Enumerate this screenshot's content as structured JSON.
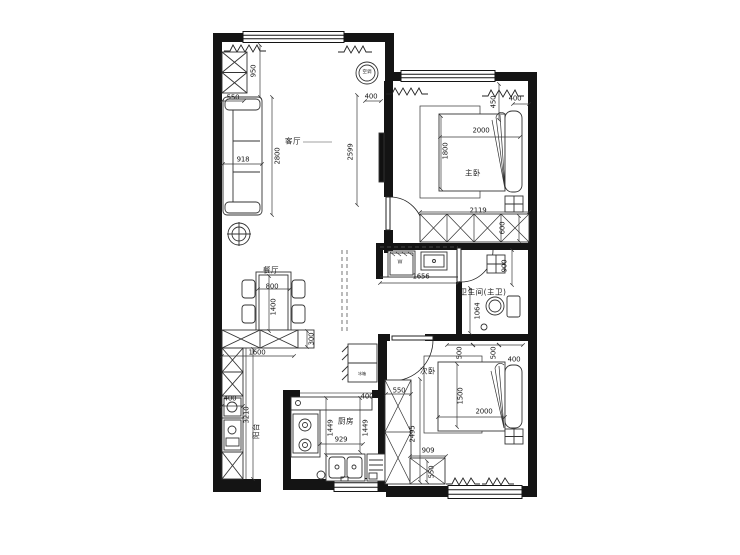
{
  "plan": {
    "room_labels": [
      {
        "text": "客厅",
        "x": 293,
        "y": 141,
        "rot": 0
      },
      {
        "text": "主卧",
        "x": 473,
        "y": 173,
        "rot": 0
      },
      {
        "text": "餐厅",
        "x": 271,
        "y": 270,
        "rot": 0
      },
      {
        "text": "卫生间(主卫)",
        "x": 483,
        "y": 292,
        "rot": 0
      },
      {
        "text": "次卧",
        "x": 428,
        "y": 371,
        "rot": 0
      },
      {
        "text": "厨房",
        "x": 346,
        "y": 421,
        "rot": 0
      },
      {
        "text": "阳台",
        "x": 256,
        "y": 431,
        "rot": 90
      }
    ],
    "dim_labels": [
      {
        "text": "950",
        "x": 254,
        "y": 71,
        "rot": 90
      },
      {
        "text": "550",
        "x": 233,
        "y": 98,
        "rot": 0
      },
      {
        "text": "918",
        "x": 243,
        "y": 160,
        "rot": 0
      },
      {
        "text": "2800",
        "x": 278,
        "y": 156,
        "rot": 90
      },
      {
        "text": "2599",
        "x": 351,
        "y": 152,
        "rot": 90
      },
      {
        "text": "400",
        "x": 371,
        "y": 97,
        "rot": 0
      },
      {
        "text": "450",
        "x": 494,
        "y": 102,
        "rot": 90
      },
      {
        "text": "400",
        "x": 515,
        "y": 99,
        "rot": 0
      },
      {
        "text": "2000",
        "x": 481,
        "y": 131,
        "rot": 0
      },
      {
        "text": "1800",
        "x": 446,
        "y": 151,
        "rot": 90
      },
      {
        "text": "2119",
        "x": 478,
        "y": 211,
        "rot": 0
      },
      {
        "text": "600",
        "x": 503,
        "y": 228,
        "rot": 90
      },
      {
        "text": "1656",
        "x": 421,
        "y": 277,
        "rot": 0
      },
      {
        "text": "900",
        "x": 505,
        "y": 266,
        "rot": 90
      },
      {
        "text": "1064",
        "x": 478,
        "y": 311,
        "rot": 90
      },
      {
        "text": "800",
        "x": 272,
        "y": 287,
        "rot": 0
      },
      {
        "text": "1400",
        "x": 274,
        "y": 307,
        "rot": 90
      },
      {
        "text": "300",
        "x": 312,
        "y": 339,
        "rot": 90
      },
      {
        "text": "1600",
        "x": 257,
        "y": 353,
        "rot": 0
      },
      {
        "text": "400",
        "x": 230,
        "y": 399,
        "rot": 0
      },
      {
        "text": "3210",
        "x": 247,
        "y": 415,
        "rot": 90
      },
      {
        "text": "1449",
        "x": 331,
        "y": 428,
        "rot": 90
      },
      {
        "text": "929",
        "x": 341,
        "y": 440,
        "rot": 0
      },
      {
        "text": "1449",
        "x": 366,
        "y": 428,
        "rot": 90
      },
      {
        "text": "400",
        "x": 367,
        "y": 397,
        "rot": 0
      },
      {
        "text": "550",
        "x": 399,
        "y": 391,
        "rot": 0
      },
      {
        "text": "500",
        "x": 460,
        "y": 353,
        "rot": 90
      },
      {
        "text": "500",
        "x": 494,
        "y": 353,
        "rot": 90
      },
      {
        "text": "400",
        "x": 514,
        "y": 360,
        "rot": 0
      },
      {
        "text": "1500",
        "x": 461,
        "y": 396,
        "rot": 90
      },
      {
        "text": "2000",
        "x": 484,
        "y": 412,
        "rot": 0
      },
      {
        "text": "2495",
        "x": 413,
        "y": 434,
        "rot": 90
      },
      {
        "text": "909",
        "x": 428,
        "y": 451,
        "rot": 0
      },
      {
        "text": "550",
        "x": 432,
        "y": 472,
        "rot": 90
      }
    ],
    "fixture_labels": [
      {
        "text": "空调",
        "x": 367,
        "y": 73,
        "rot": 0,
        "size": 4.5
      },
      {
        "text": "W",
        "x": 400,
        "y": 263,
        "rot": 0,
        "size": 5
      },
      {
        "text": "冰箱",
        "x": 362,
        "y": 374,
        "rot": 0,
        "size": 4
      }
    ]
  }
}
